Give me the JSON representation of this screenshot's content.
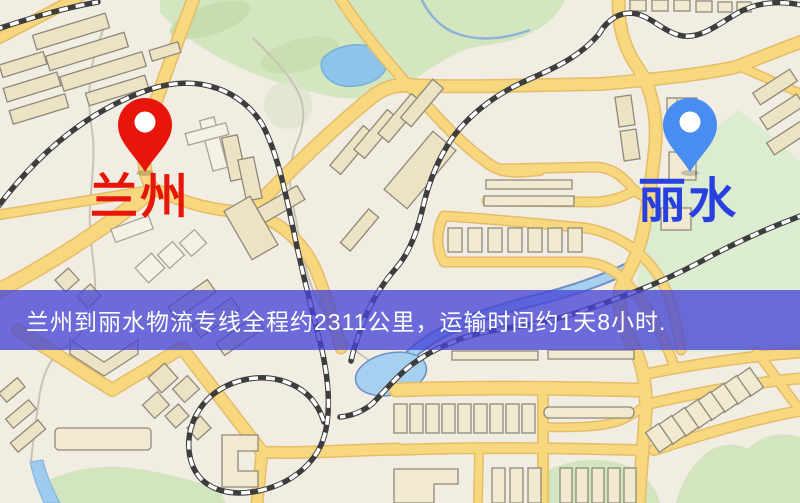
{
  "banner": {
    "text": "兰州到丽水物流专线全程约2311公里，运输时间约1天8小时.",
    "background_color": "#4845d6",
    "text_color": "#ffffff"
  },
  "origin": {
    "label": "兰州",
    "pin_color": "#e8150b",
    "label_color": "#e8150b",
    "pin_icon": "red-map-pin-icon"
  },
  "destination": {
    "label": "丽水",
    "pin_color": "#4a8df2",
    "label_color": "#2940e0",
    "pin_icon": "blue-map-pin-icon"
  },
  "map_colors": {
    "background": "#f2ede3",
    "road": "#f7d87f",
    "road_casing": "#e5bc68",
    "railway": "#3d3d3d",
    "building": "#ece2c4",
    "park": "#d3e6c0",
    "water": "#a6d0f0"
  }
}
